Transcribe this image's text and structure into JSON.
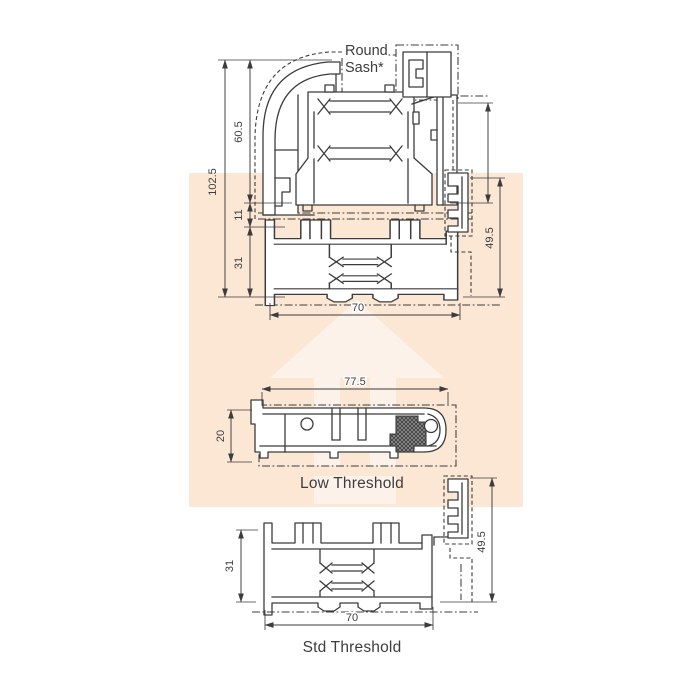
{
  "watermark": {
    "bg_color": "#fce7d5",
    "arrow_color": "#fdf2e9"
  },
  "top_drawing": {
    "label_line1": "Round",
    "label_line2": "Sash*",
    "dim_overall_height": "102.5",
    "dim_sash_height": "60.5",
    "dim_gap": "11",
    "dim_base_height": "31",
    "dim_addon_height": "49.5",
    "dim_width": "70"
  },
  "low_threshold": {
    "caption": "Low Threshold",
    "dim_width": "77.5",
    "dim_height": "20"
  },
  "std_threshold": {
    "caption": "Std Threshold",
    "dim_base_height": "31",
    "dim_addon_height": "49.5",
    "dim_width": "70"
  }
}
